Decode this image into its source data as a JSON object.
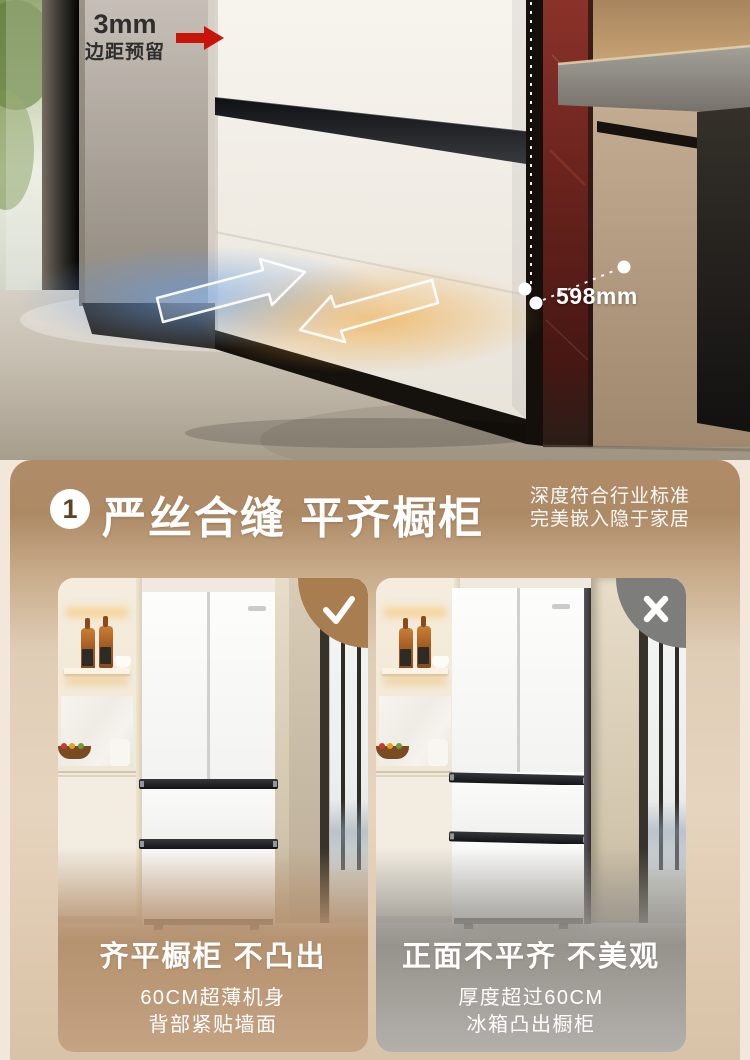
{
  "top_photo": {
    "margin_value": "3mm",
    "margin_text": "边距预留",
    "depth_label": "598mm"
  },
  "feature_card": {
    "badge_number": "1",
    "title": "严丝合缝 平齐橱柜",
    "subtitle_line1": "深度符合行业标准",
    "subtitle_line2": "完美嵌入隐于家居",
    "good_panel": {
      "mark_icon": "check",
      "title": "齐平橱柜 不凸出",
      "line1": "60CM超薄机身",
      "line2": "背部紧贴墙面"
    },
    "bad_panel": {
      "mark_icon": "cross",
      "title": "正面不平齐 不美观",
      "line1": "厚度超过60CM",
      "line2": "冰箱凸出橱柜"
    }
  },
  "colors": {
    "accent_red": "#c8150c",
    "badge_brown": "#a87e50",
    "badge_gray": "#7d7d7b",
    "card_top": "#b08b67",
    "card_mid": "#e7d4be",
    "card_bottom": "#d8c2a8",
    "overlay_good": "#b5926f",
    "overlay_bad": "#96938d",
    "page_bg": "#f2e7da"
  }
}
